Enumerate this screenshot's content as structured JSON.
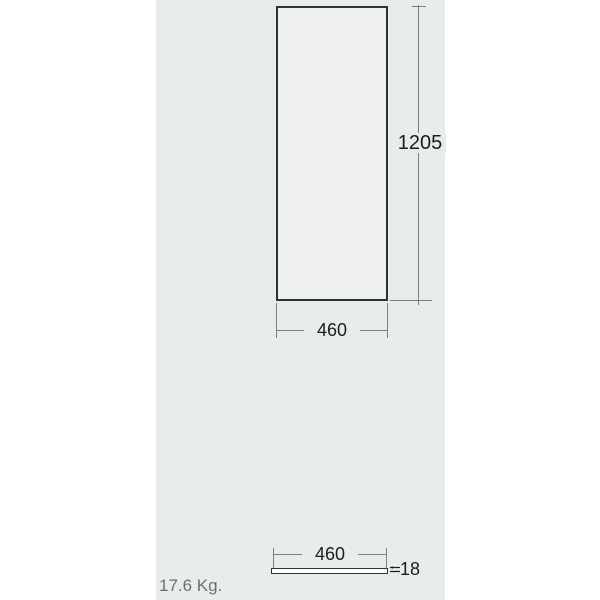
{
  "front_view": {
    "height_dim": "1205",
    "width_dim": "460"
  },
  "side_view": {
    "width_dim": "460",
    "thickness_dim": "18"
  },
  "weight": "17.6 Kg.",
  "icons": {
    "thickness_arrows": "thickness-arrows-icon"
  },
  "colors": {
    "page_background": "#ffffff",
    "panel_background": "#e9eced",
    "outline": "#2e3233",
    "front_view_fill": "#eef0f1",
    "side_bar_fill": "#ffffff",
    "dimension_line": "#7b8183",
    "dimension_text": "#1b1d1e",
    "weight_text": "#6f6f6f"
  }
}
